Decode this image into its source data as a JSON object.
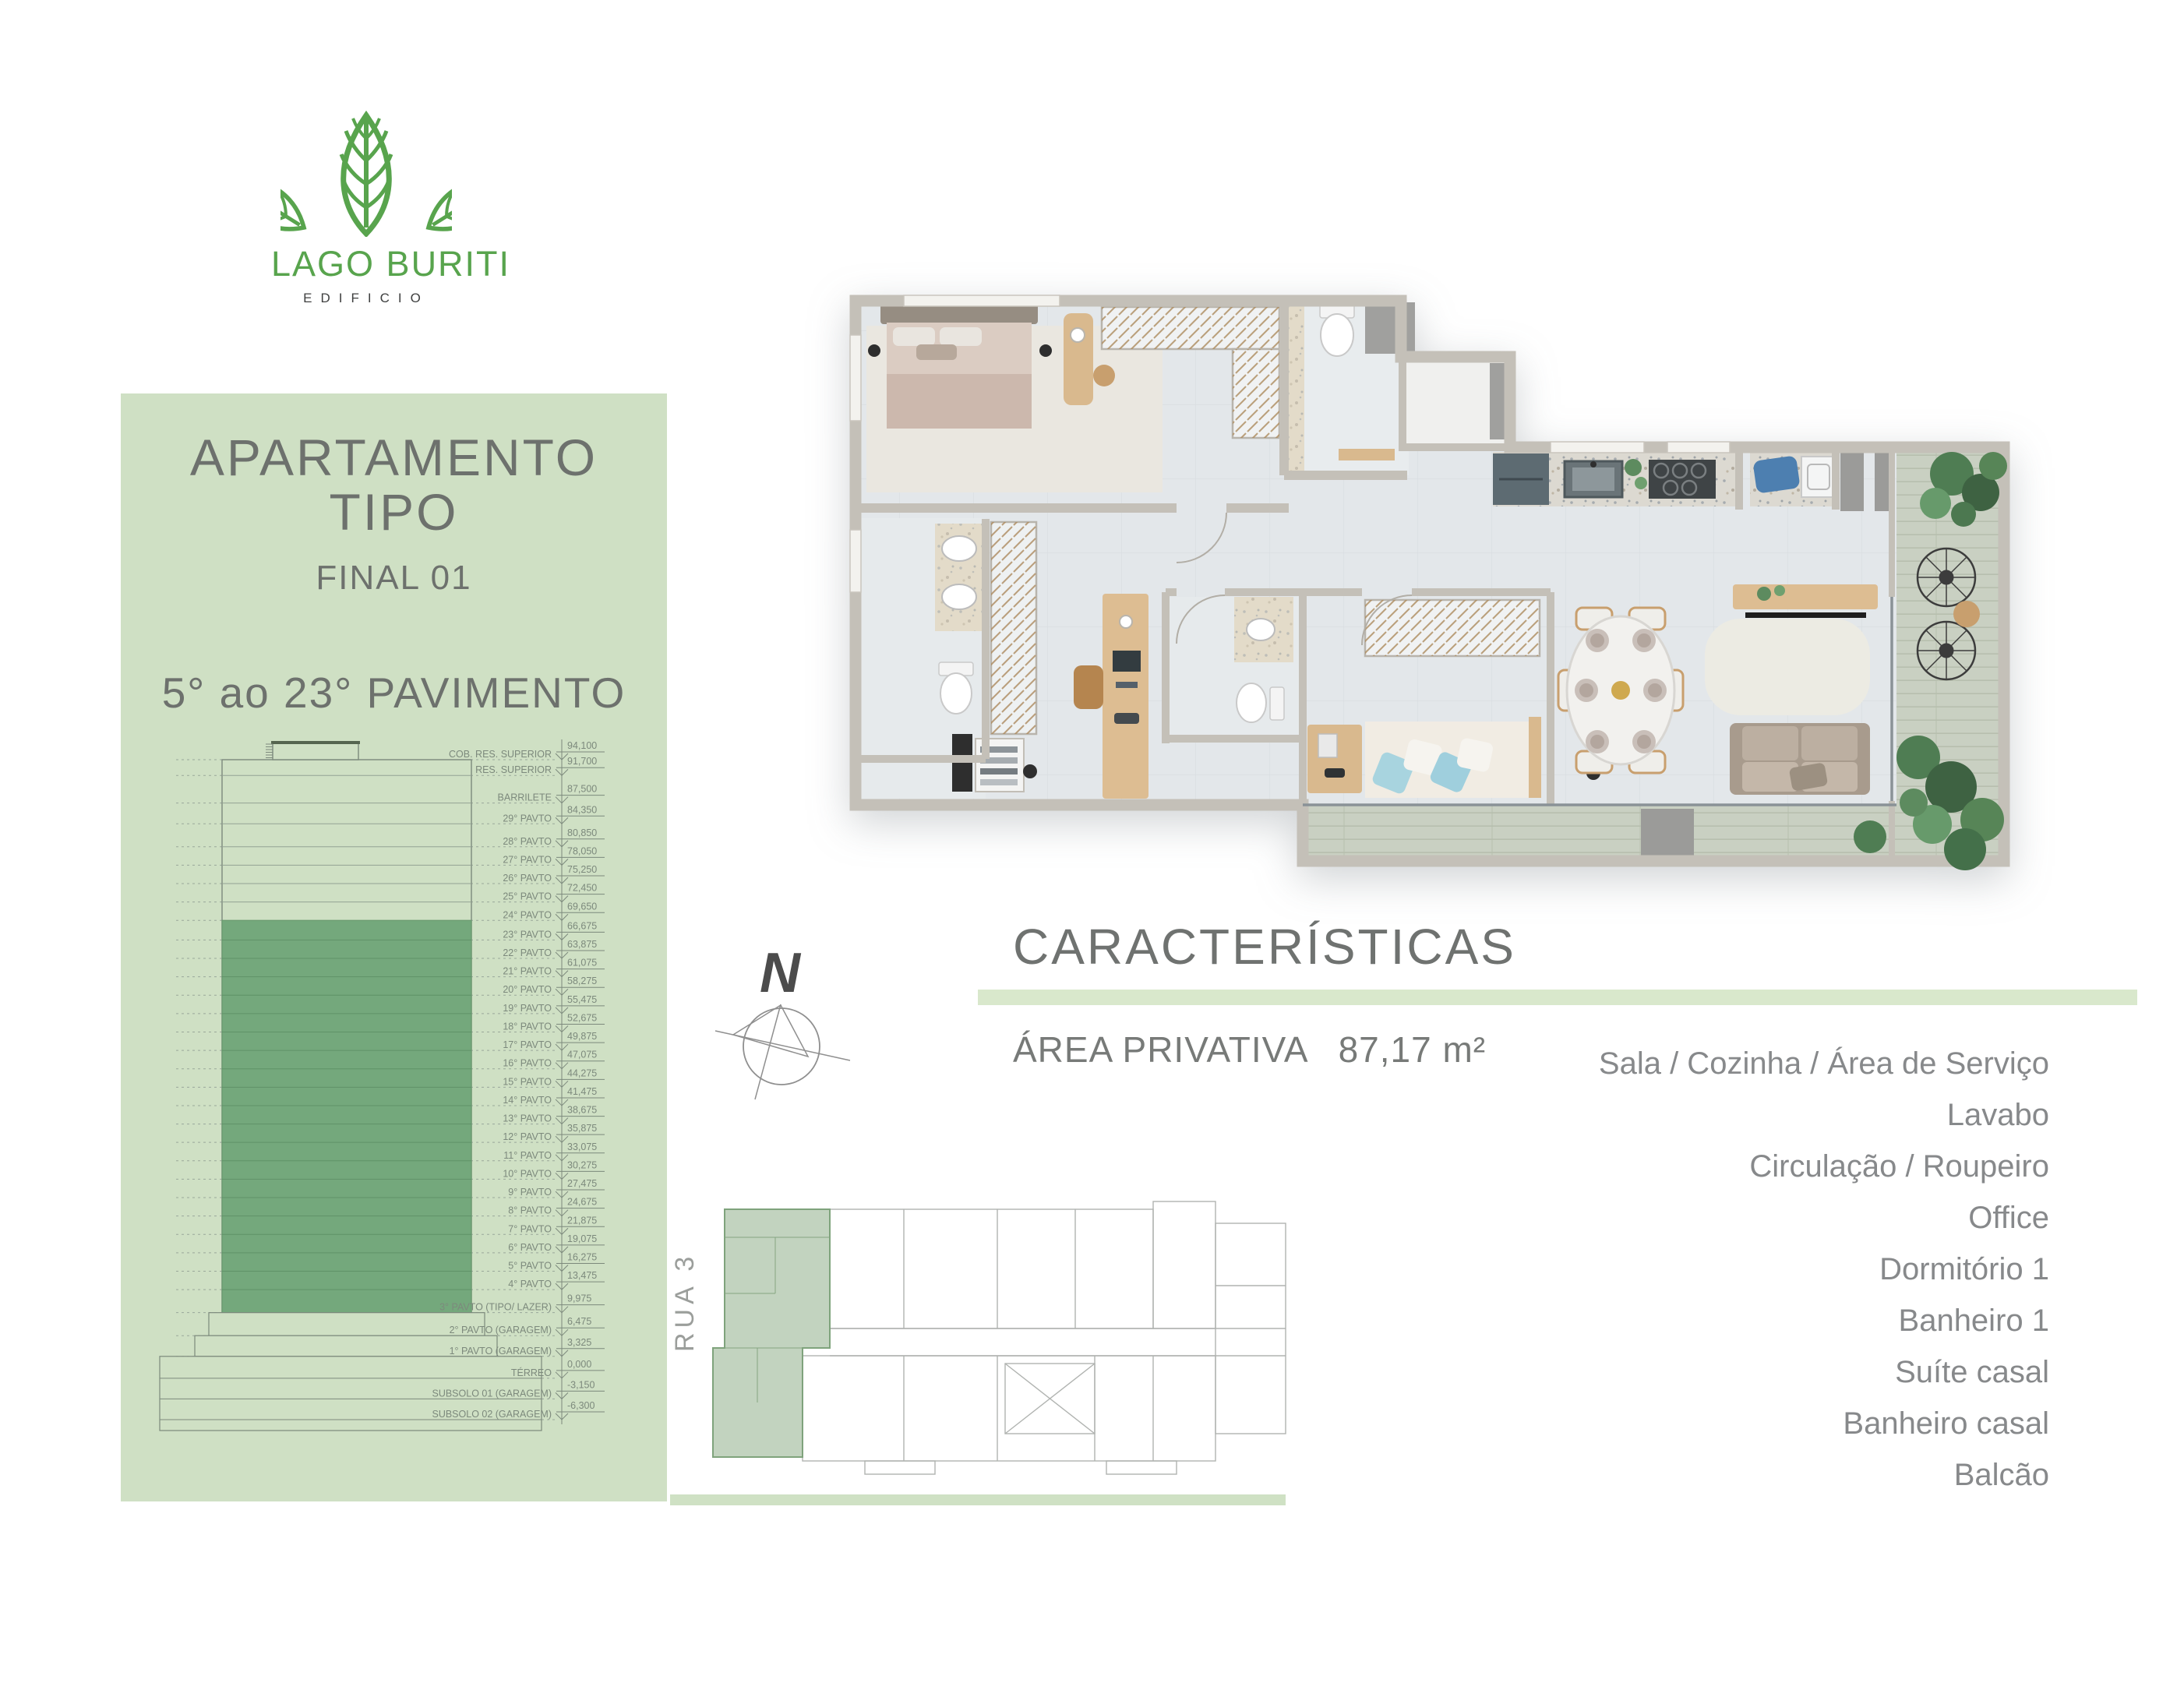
{
  "logo": {
    "title": "LAGO BURITI",
    "subtitle": "EDIFICIO"
  },
  "panel": {
    "title_line1": "APARTAMENTO",
    "title_line2": "TIPO",
    "final": "FINAL 01",
    "range": "5° ao 23° PAVIMENTO"
  },
  "elevation": {
    "levels": [
      {
        "label": "COB. RES. SUPERIOR",
        "value": "94,100",
        "elev": 94.1
      },
      {
        "label": "RES. SUPERIOR",
        "value": "91,700",
        "elev": 91.7
      },
      {
        "label": "BARRILETE",
        "value": "87,500",
        "elev": 87.5
      },
      {
        "label": "29° PAVTO",
        "value": "84,350",
        "elev": 84.35
      },
      {
        "label": "28° PAVTO",
        "value": "80,850",
        "elev": 80.85
      },
      {
        "label": "27° PAVTO",
        "value": "78,050",
        "elev": 78.05
      },
      {
        "label": "26° PAVTO",
        "value": "75,250",
        "elev": 75.25
      },
      {
        "label": "25° PAVTO",
        "value": "72,450",
        "elev": 72.45
      },
      {
        "label": "24° PAVTO",
        "value": "69,650",
        "elev": 69.65
      },
      {
        "label": "23° PAVTO",
        "value": "66,675",
        "elev": 66.675
      },
      {
        "label": "22° PAVTO",
        "value": "63,875",
        "elev": 63.875
      },
      {
        "label": "21° PAVTO",
        "value": "61,075",
        "elev": 61.075
      },
      {
        "label": "20° PAVTO",
        "value": "58,275",
        "elev": 58.275
      },
      {
        "label": "19° PAVTO",
        "value": "55,475",
        "elev": 55.475
      },
      {
        "label": "18° PAVTO",
        "value": "52,675",
        "elev": 52.675
      },
      {
        "label": "17° PAVTO",
        "value": "49,875",
        "elev": 49.875
      },
      {
        "label": "16° PAVTO",
        "value": "47,075",
        "elev": 47.075
      },
      {
        "label": "15° PAVTO",
        "value": "44,275",
        "elev": 44.275
      },
      {
        "label": "14° PAVTO",
        "value": "41,475",
        "elev": 41.475
      },
      {
        "label": "13° PAVTO",
        "value": "38,675",
        "elev": 38.675
      },
      {
        "label": "12° PAVTO",
        "value": "35,875",
        "elev": 35.875
      },
      {
        "label": "11° PAVTO",
        "value": "33,075",
        "elev": 33.075
      },
      {
        "label": "10° PAVTO",
        "value": "30,275",
        "elev": 30.275
      },
      {
        "label": "9° PAVTO",
        "value": "27,475",
        "elev": 27.475
      },
      {
        "label": "8° PAVTO",
        "value": "24,675",
        "elev": 24.675
      },
      {
        "label": "7° PAVTO",
        "value": "21,875",
        "elev": 21.875
      },
      {
        "label": "6° PAVTO",
        "value": "19,075",
        "elev": 19.075
      },
      {
        "label": "5° PAVTO",
        "value": "16,275",
        "elev": 16.275
      },
      {
        "label": "4° PAVTO",
        "value": "13,475",
        "elev": 13.475
      },
      {
        "label": "3° PAVTO (TIPO/ LAZER)",
        "value": "9,975",
        "elev": 9.975
      },
      {
        "label": "2° PAVTO (GARAGEM)",
        "value": "6,475",
        "elev": 6.475
      },
      {
        "label": "1° PAVTO (GARAGEM)",
        "value": "3,325",
        "elev": 3.325
      },
      {
        "label": "TÉRREO",
        "value": "0,000",
        "elev": 0
      },
      {
        "label": "SUBSOLO 01 (GARAGEM)",
        "value": "-3,150",
        "elev": -3.15
      },
      {
        "label": "SUBSOLO 02 (GARAGEM)",
        "value": "-6,300",
        "elev": -6.3
      }
    ]
  },
  "compass": {
    "north_label": "N"
  },
  "characteristics": {
    "heading": "CARACTERÍSTICAS",
    "area_label": "ÁREA PRIVATIVA",
    "area_value": "87,17 m²",
    "rooms": [
      "Sala / Cozinha / Área de Serviço",
      "Lavabo",
      "Circulação / Roupeiro",
      "Office",
      "Dormitório 1",
      "Banheiro 1",
      "Suíte casal",
      "Banheiro casal",
      "Balcão"
    ]
  },
  "siteplan": {
    "street_label": "RUA 3"
  },
  "colors": {
    "panel_green": "#cfe0c4",
    "logo_green": "#58a44d",
    "highlight_green": "#74a87c",
    "divider_green": "#d9e8cc",
    "text_gray": "#87898b",
    "heading_gray": "#6f7270",
    "diagram_gray": "#7c897c"
  }
}
